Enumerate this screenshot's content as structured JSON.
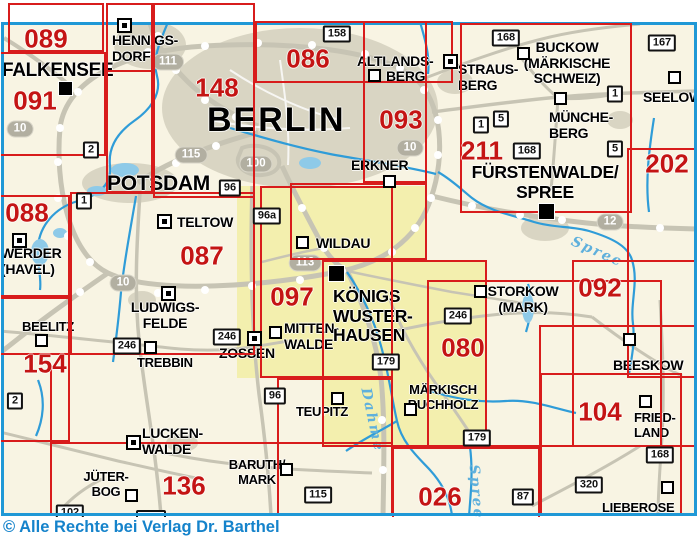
{
  "copyright": "© Alle Rechte bei Verlag Dr. Barthel",
  "colors": {
    "sheet_line": "#d81c1c",
    "sheet_number": "#c41414",
    "map_border": "#1f98d6",
    "water": "#2f9cd8",
    "road": "#c7c4b4",
    "urban": "#d9d5c3",
    "highlight": "#f3efae",
    "background": "#f8f4e3",
    "copyright_text": "#1583cb",
    "shield_gray": "#b2afa1"
  },
  "sheets": {
    "numbers": [
      {
        "label": "089",
        "x": 46,
        "y": 39
      },
      {
        "label": "091",
        "x": 35,
        "y": 101
      },
      {
        "label": "148",
        "x": 217,
        "y": 88
      },
      {
        "label": "086",
        "x": 308,
        "y": 59
      },
      {
        "label": "093",
        "x": 401,
        "y": 120
      },
      {
        "label": "211",
        "x": 482,
        "y": 151
      },
      {
        "label": "202",
        "x": 667,
        "y": 164
      },
      {
        "label": "088",
        "x": 27,
        "y": 213
      },
      {
        "label": "087",
        "x": 202,
        "y": 256
      },
      {
        "label": "097",
        "x": 292,
        "y": 297
      },
      {
        "label": "092",
        "x": 600,
        "y": 288
      },
      {
        "label": "154",
        "x": 45,
        "y": 364
      },
      {
        "label": "080",
        "x": 463,
        "y": 348
      },
      {
        "label": "136",
        "x": 184,
        "y": 486
      },
      {
        "label": "026",
        "x": 440,
        "y": 497
      },
      {
        "label": "104",
        "x": 600,
        "y": 412
      }
    ],
    "boxes": [
      {
        "x": 8,
        "y": 3,
        "w": 96,
        "h": 49
      },
      {
        "x": -8,
        "y": 52,
        "w": 114,
        "h": 104
      },
      {
        "x": 106,
        "y": 3,
        "w": 47,
        "h": 69
      },
      {
        "x": 106,
        "y": 3,
        "w": 47,
        "h": 190
      },
      {
        "x": 153,
        "y": 3,
        "w": 102,
        "h": 195
      },
      {
        "x": 255,
        "y": 21,
        "w": 198,
        "h": 62
      },
      {
        "x": 363,
        "y": 21,
        "w": 64,
        "h": 162
      },
      {
        "x": -8,
        "y": 195,
        "w": 78,
        "h": 102
      },
      {
        "x": 70,
        "y": 192,
        "w": 185,
        "h": 163
      },
      {
        "x": -8,
        "y": 297,
        "w": 78,
        "h": 58
      },
      {
        "x": -8,
        "y": 297,
        "w": 78,
        "h": 145
      },
      {
        "x": 260,
        "y": 186,
        "w": 133,
        "h": 192
      },
      {
        "x": 290,
        "y": 183,
        "w": 137,
        "h": 77
      },
      {
        "x": 322,
        "y": 260,
        "w": 165,
        "h": 187
      },
      {
        "x": 427,
        "y": 280,
        "w": 235,
        "h": 167
      },
      {
        "x": 460,
        "y": 23,
        "w": 172,
        "h": 190
      },
      {
        "x": 627,
        "y": 148,
        "w": 95,
        "h": 230
      },
      {
        "x": 572,
        "y": 260,
        "w": 150,
        "h": 187
      },
      {
        "x": 539,
        "y": 325,
        "w": 160,
        "h": 122
      },
      {
        "x": 392,
        "y": 447,
        "w": 148,
        "h": 85
      },
      {
        "x": 540,
        "y": 373,
        "w": 142,
        "h": 142
      },
      {
        "x": 277,
        "y": 378,
        "w": 116,
        "h": 137
      }
    ],
    "lines": [
      {
        "x": 50,
        "y": 368,
        "w": 2,
        "h": 147
      },
      {
        "x": 50,
        "y": 442,
        "w": 343,
        "h": 2
      }
    ]
  },
  "cities": [
    {
      "id": "falkensee",
      "lines": [
        "FALKENSEE"
      ],
      "x": 2,
      "y": 60,
      "size": 19,
      "align": "left",
      "sym": {
        "type": "filled",
        "x": 58,
        "y": 81,
        "s": 15
      }
    },
    {
      "id": "hennigsdorf",
      "lines": [
        "HENNIGS-",
        "DORF"
      ],
      "x": 112,
      "y": 33,
      "size": 14,
      "align": "left",
      "sym": {
        "type": "boxed",
        "x": 117,
        "y": 18,
        "s": 15
      }
    },
    {
      "id": "potsdam",
      "lines": [
        "POTSDAM"
      ],
      "x": 107,
      "y": 172,
      "size": 21,
      "align": "left",
      "sym": null
    },
    {
      "id": "berlin",
      "lines": [
        "BERLIN"
      ],
      "x": 207,
      "y": 101,
      "size": 34,
      "align": "left",
      "sym": null,
      "ls": 2
    },
    {
      "id": "teltow",
      "lines": [
        "TELTOW"
      ],
      "x": 177,
      "y": 215,
      "size": 14,
      "align": "left",
      "sym": {
        "type": "boxed",
        "x": 157,
        "y": 214,
        "s": 15
      }
    },
    {
      "id": "werder-havel",
      "lines": [
        "WERDER",
        "(HAVEL)"
      ],
      "x": 1,
      "y": 246,
      "size": 14,
      "align": "left",
      "sym": {
        "type": "boxed",
        "x": 12,
        "y": 233,
        "s": 15
      }
    },
    {
      "id": "ludwigsfelde",
      "lines": [
        "LUDWIGS-",
        "FELDE"
      ],
      "x": 165,
      "y": 300,
      "size": 14,
      "align": "center",
      "sym": {
        "type": "boxed",
        "x": 161,
        "y": 286,
        "s": 15
      }
    },
    {
      "id": "beelitz",
      "lines": [
        "BEELITZ"
      ],
      "x": 22,
      "y": 320,
      "size": 13,
      "align": "left",
      "sym": {
        "type": "open",
        "x": 35,
        "y": 334,
        "s": 13
      }
    },
    {
      "id": "trebbin",
      "lines": [
        "TREBBIN"
      ],
      "x": 137,
      "y": 356,
      "size": 13,
      "align": "left",
      "sym": {
        "type": "open",
        "x": 144,
        "y": 341,
        "s": 13
      }
    },
    {
      "id": "zossen",
      "lines": [
        "ZOSSEN"
      ],
      "x": 219,
      "y": 346,
      "size": 14,
      "align": "left",
      "sym": {
        "type": "boxed",
        "x": 247,
        "y": 331,
        "s": 15
      }
    },
    {
      "id": "mittenwalde",
      "lines": [
        "MITTEN-",
        "WALDE"
      ],
      "x": 284,
      "y": 321,
      "size": 14,
      "align": "left",
      "sym": {
        "type": "open",
        "x": 269,
        "y": 326,
        "s": 13
      }
    },
    {
      "id": "wildau",
      "lines": [
        "WILDAU"
      ],
      "x": 316,
      "y": 236,
      "size": 14,
      "align": "left",
      "sym": {
        "type": "open",
        "x": 296,
        "y": 236,
        "s": 13
      }
    },
    {
      "id": "koenigs-wusterhausen",
      "lines": [
        "KÖNIGS",
        "WUSTER-",
        "HAUSEN"
      ],
      "x": 333,
      "y": 287,
      "size": 17.5,
      "align": "left",
      "sym": {
        "type": "filled",
        "x": 328,
        "y": 265,
        "s": 17
      }
    },
    {
      "id": "erkner",
      "lines": [
        "ERKNER"
      ],
      "x": 351,
      "y": 158,
      "size": 14,
      "align": "left",
      "sym": {
        "type": "open",
        "x": 383,
        "y": 175,
        "s": 13
      }
    },
    {
      "id": "altlandsberg",
      "lines": [
        "ALTLANDS-"
      ],
      "x": 357,
      "y": 54,
      "size": 14,
      "align": "left",
      "sym": null
    },
    {
      "id": "altlandsberg-2",
      "lines": [
        "BERG"
      ],
      "x": 386,
      "y": 69,
      "size": 14,
      "align": "left",
      "sym": {
        "type": "open",
        "x": 368,
        "y": 69,
        "s": 13
      }
    },
    {
      "id": "strausberg",
      "lines": [
        "STRAUS-",
        "BERG"
      ],
      "x": 458,
      "y": 62,
      "size": 14,
      "align": "left",
      "sym": {
        "type": "boxed",
        "x": 443,
        "y": 54,
        "s": 15
      }
    },
    {
      "id": "buckow",
      "lines": [
        "BUCKOW",
        "(MÄRKISCHE",
        "SCHWEIZ)"
      ],
      "x": 567,
      "y": 40,
      "size": 14,
      "align": "center",
      "sym": {
        "type": "open",
        "x": 517,
        "y": 47,
        "s": 13
      }
    },
    {
      "id": "muencheberg",
      "lines": [
        "MÜNCHE-",
        "BERG"
      ],
      "x": 549,
      "y": 110,
      "size": 14,
      "align": "left",
      "sym": {
        "type": "open",
        "x": 554,
        "y": 92,
        "s": 13
      }
    },
    {
      "id": "seelow",
      "lines": [
        "SEELOW"
      ],
      "x": 643,
      "y": 90,
      "size": 14,
      "align": "left",
      "sym": {
        "type": "open",
        "x": 668,
        "y": 71,
        "s": 13
      }
    },
    {
      "id": "fuerstenwalde-spree",
      "lines": [
        "FÜRSTENWALDE/",
        "SPREE"
      ],
      "x": 545,
      "y": 163,
      "size": 17.5,
      "align": "center",
      "sym": {
        "type": "filled",
        "x": 538,
        "y": 203,
        "s": 17
      }
    },
    {
      "id": "storkow-mark",
      "lines": [
        "STORKOW",
        "(MARK)"
      ],
      "x": 523,
      "y": 284,
      "size": 14,
      "align": "center",
      "sym": {
        "type": "open",
        "x": 474,
        "y": 285,
        "s": 13
      }
    },
    {
      "id": "beeskow",
      "lines": [
        "BEESKOW"
      ],
      "x": 613,
      "y": 358,
      "size": 14,
      "align": "left",
      "sym": {
        "type": "open",
        "x": 623,
        "y": 333,
        "s": 13
      }
    },
    {
      "id": "maerkisch-buchholz",
      "lines": [
        "MÄRKISCH",
        "BUCHHOLZ"
      ],
      "x": 443,
      "y": 383,
      "size": 13,
      "align": "center",
      "sym": {
        "type": "open",
        "x": 404,
        "y": 403,
        "s": 13
      }
    },
    {
      "id": "teupitz",
      "lines": [
        "TEUPITZ"
      ],
      "x": 296,
      "y": 405,
      "size": 13,
      "align": "left",
      "sym": {
        "type": "open",
        "x": 331,
        "y": 392,
        "s": 13
      }
    },
    {
      "id": "baruth-mark",
      "lines": [
        "BARUTH/",
        "MARK"
      ],
      "x": 257,
      "y": 458,
      "size": 13,
      "align": "center",
      "sym": {
        "type": "open",
        "x": 280,
        "y": 463,
        "s": 13
      }
    },
    {
      "id": "luckenwalde",
      "lines": [
        "LUCKEN-",
        "WALDE"
      ],
      "x": 142,
      "y": 426,
      "size": 14,
      "align": "left",
      "sym": {
        "type": "boxed",
        "x": 126,
        "y": 435,
        "s": 15
      }
    },
    {
      "id": "jueterbog",
      "lines": [
        "JÜTER-",
        "BOG"
      ],
      "x": 106,
      "y": 470,
      "size": 13,
      "align": "center",
      "sym": {
        "type": "open",
        "x": 125,
        "y": 489,
        "s": 13
      }
    },
    {
      "id": "friedland",
      "lines": [
        "FRIED-",
        "LAND"
      ],
      "x": 634,
      "y": 411,
      "size": 13,
      "align": "left",
      "sym": {
        "type": "open",
        "x": 639,
        "y": 395,
        "s": 13
      }
    },
    {
      "id": "lieberose",
      "lines": [
        "LIEBEROSE"
      ],
      "x": 602,
      "y": 501,
      "size": 13,
      "align": "left",
      "sym": {
        "type": "open",
        "x": 661,
        "y": 481,
        "s": 13
      }
    }
  ],
  "road_badges": [
    {
      "label": "158",
      "x": 337,
      "y": 34
    },
    {
      "label": "167",
      "x": 662,
      "y": 43
    },
    {
      "label": "168",
      "x": 506,
      "y": 38
    },
    {
      "label": "168",
      "x": 527,
      "y": 151
    },
    {
      "label": "168",
      "x": 660,
      "y": 455
    },
    {
      "label": "1",
      "x": 481,
      "y": 125
    },
    {
      "label": "5",
      "x": 501,
      "y": 119
    },
    {
      "label": "1",
      "x": 615,
      "y": 94
    },
    {
      "label": "5",
      "x": 615,
      "y": 149
    },
    {
      "label": "2",
      "x": 91,
      "y": 150
    },
    {
      "label": "1",
      "x": 84,
      "y": 201
    },
    {
      "label": "96",
      "x": 230,
      "y": 188
    },
    {
      "label": "96a",
      "x": 267,
      "y": 216
    },
    {
      "label": "2",
      "x": 15,
      "y": 401
    },
    {
      "label": "246",
      "x": 127,
      "y": 346
    },
    {
      "label": "246",
      "x": 227,
      "y": 337
    },
    {
      "label": "246",
      "x": 458,
      "y": 316
    },
    {
      "label": "179",
      "x": 386,
      "y": 362
    },
    {
      "label": "179",
      "x": 477,
      "y": 438
    },
    {
      "label": "96",
      "x": 275,
      "y": 396
    },
    {
      "label": "115",
      "x": 318,
      "y": 495
    },
    {
      "label": "102",
      "x": 70,
      "y": 513
    },
    {
      "label": "320",
      "x": 589,
      "y": 485
    },
    {
      "label": "87",
      "x": 523,
      "y": 497
    }
  ],
  "cut_badges": [
    {
      "x": 136,
      "y": 510,
      "w": 26,
      "h": 12
    }
  ],
  "motorway_shields": [
    {
      "label": "10",
      "x": 20,
      "y": 129
    },
    {
      "label": "111",
      "x": 168,
      "y": 62
    },
    {
      "label": "115",
      "x": 191,
      "y": 155
    },
    {
      "label": "100",
      "x": 256,
      "y": 164
    },
    {
      "label": "10",
      "x": 410,
      "y": 148
    },
    {
      "label": "113",
      "x": 305,
      "y": 263
    },
    {
      "label": "10",
      "x": 123,
      "y": 283
    },
    {
      "label": "12",
      "x": 610,
      "y": 222
    }
  ],
  "water_labels": [
    {
      "label": "Spree",
      "x": 597,
      "y": 252,
      "rot": 24
    },
    {
      "label": "Spree",
      "x": 476,
      "y": 492,
      "rot": 85
    },
    {
      "label": "Dahme",
      "x": 372,
      "y": 420,
      "rot": 78
    }
  ]
}
